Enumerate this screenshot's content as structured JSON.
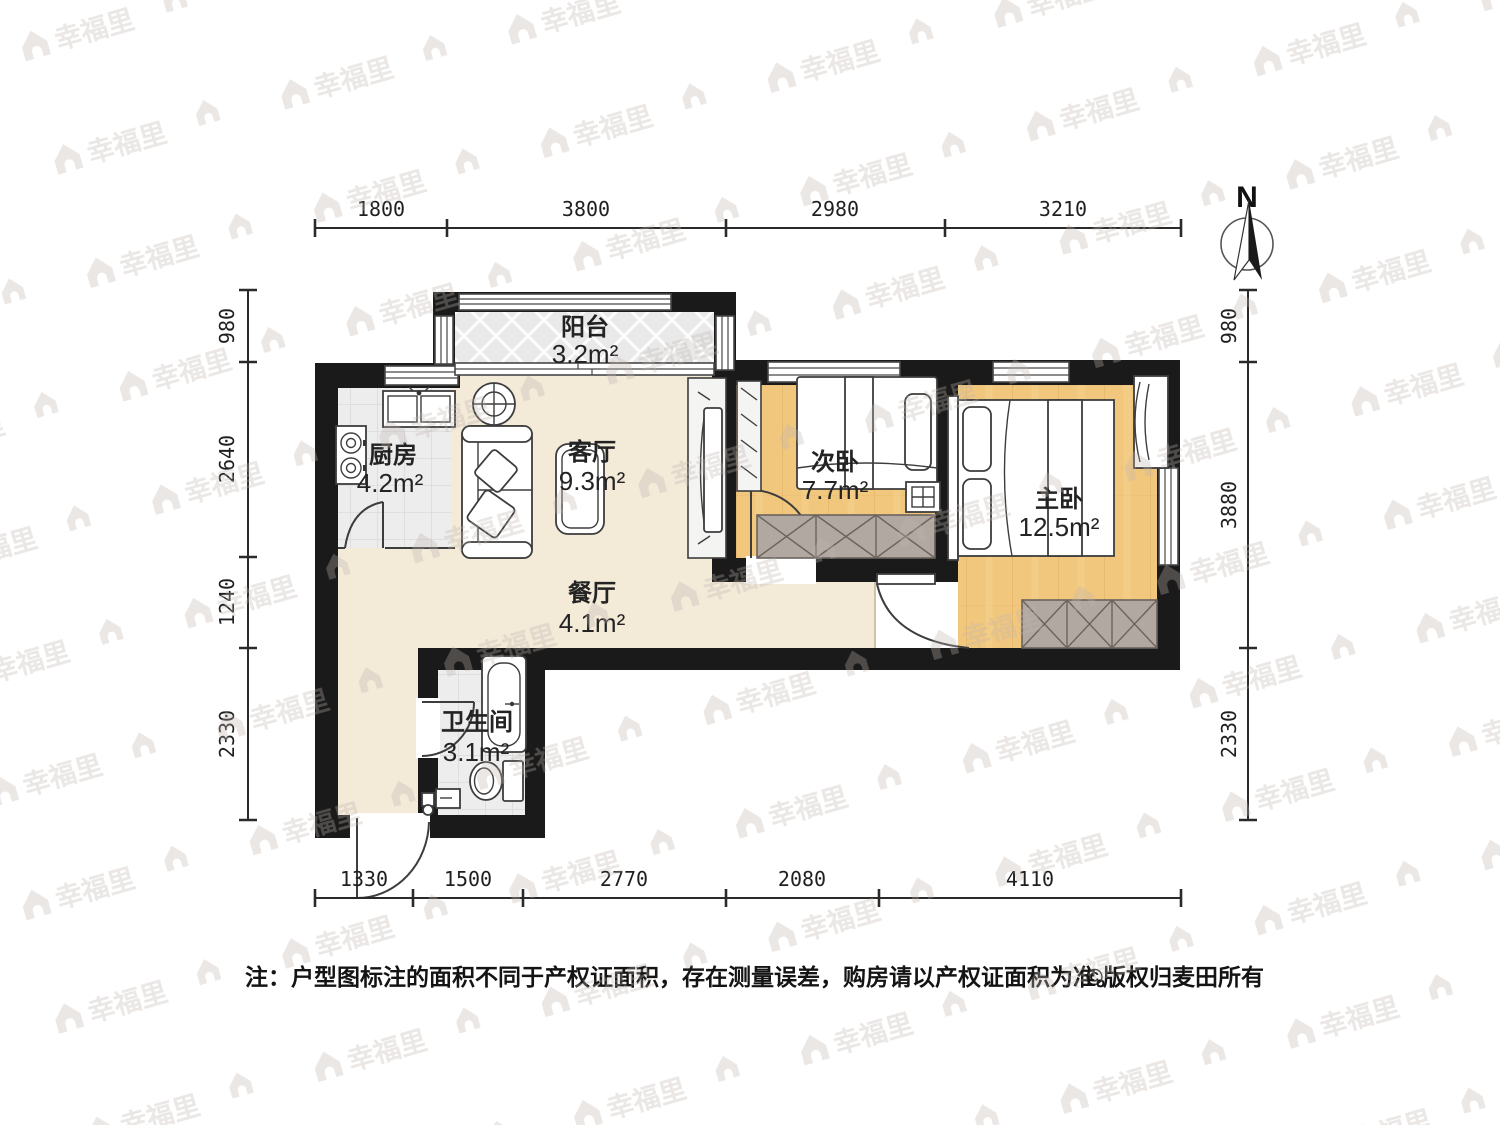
{
  "compass": {
    "north_label": "N"
  },
  "watermark": {
    "text": "幸福里"
  },
  "note": {
    "text": "注：户型图标注的面积不同于产权证面积，存在测量误差，购房请以产权证面积为准。",
    "copyright": "©版权归麦田所有"
  },
  "rooms": {
    "balcony": {
      "name": "阳台",
      "area": "3.2m²"
    },
    "kitchen": {
      "name": "厨房",
      "area": "4.2m²"
    },
    "living": {
      "name": "客厅",
      "area": "9.3m²"
    },
    "dining": {
      "name": "餐厅",
      "area": "4.1m²"
    },
    "bathroom": {
      "name": "卫生间",
      "area": "3.1m²"
    },
    "bedroom2": {
      "name": "次卧",
      "area": "7.7m²"
    },
    "master": {
      "name": "主卧",
      "area": "12.5m²"
    }
  },
  "dimensions": {
    "top": [
      "1800",
      "3800",
      "2980",
      "3210"
    ],
    "bottom": [
      "1330",
      "1500",
      "2770",
      "2080",
      "4110"
    ],
    "left": [
      "980",
      "2640",
      "1240",
      "2330"
    ],
    "right": [
      "980",
      "3880",
      "2330"
    ]
  },
  "colors": {
    "wall": "#1a1a1a",
    "floor-beige": "#f3ead8",
    "floor-wood": "#f1c77d",
    "floor-tile": "#ededed",
    "floor-balcony": "#e9e9e9",
    "wardrobe": "#b2a8a2",
    "dim": "#2a2a2a",
    "watermark": "#beb3ae"
  }
}
